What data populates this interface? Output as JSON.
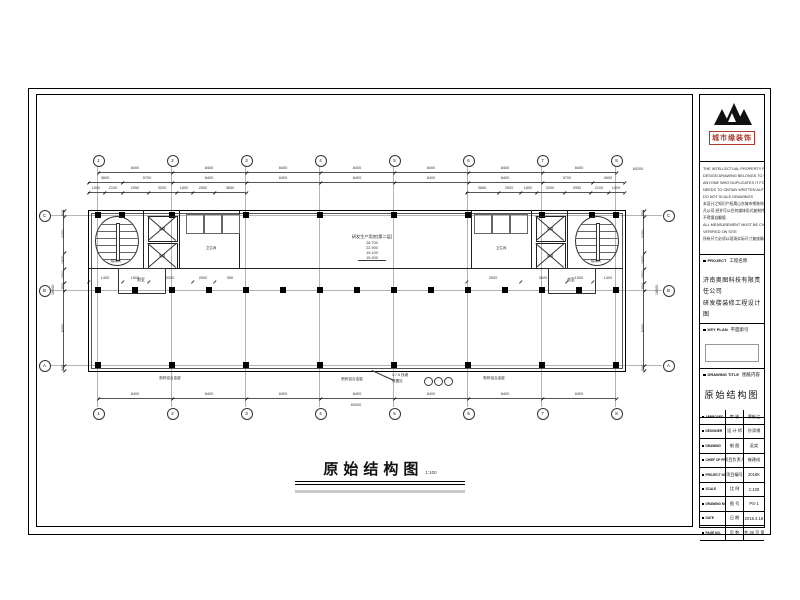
{
  "page": {
    "title_main": "原始结构图",
    "title_scale_label": "比例",
    "title_scale": "1:100"
  },
  "logo": {
    "name": "城市缘装饰",
    "accent_color": "#b03a2e"
  },
  "disclaimer": {
    "lines": [
      "THE INTELLECTUAL PROPERTY RIGHT OF THIS",
      "DESIGN DRAWING BELONGS TO DECORATION CO.,LTD",
      "ANYONE WHO DUPLICATES IT FOR USE",
      "NEEDS TO OBTAIN WRITTEN AUTHORIZATION",
      "DO NOT SCALE DRAWINGS",
      "本设计之知识产权属山东城市缘装饰所有",
      "凡公司,经许可以任何媒体形式复制传播,",
      "不得擅自翻版.",
      "ALL MEASUREMENT MUST BE CHECKED AND",
      "VERIFIED ON SITE",
      "所有尺寸必须以现场实际尺寸复核确认无误"
    ]
  },
  "title_block": {
    "project_label_en": "PROJECT",
    "project_label_cn": "工程名称",
    "project_name_line1": "济南奥图科技有限责任公司",
    "project_name_line2": "研发楼装修工程设计图",
    "key_plan_label_en": "KEY PLAN",
    "key_plan_label_cn": "平面索引",
    "drawing_title_label_en": "DRAWING TITLE",
    "drawing_title_label_cn": "图纸内容",
    "drawing_title_value": "原始结构图",
    "rows": [
      {
        "en": "APPROVED",
        "cn": "审 核",
        "value": "贾彬江"
      },
      {
        "en": "DESIGNER",
        "cn": "设 计 师",
        "value": "孙添祺"
      },
      {
        "en": "DRAWING",
        "cn": "制 图",
        "value": "吴笑"
      },
      {
        "en": "CHIEF OF PRO",
        "cn": "项目负责人",
        "value": "崔建成"
      },
      {
        "en": "PROJECT NO.",
        "cn": "项目编号",
        "value": "2016K"
      },
      {
        "en": "SCALE",
        "cn": "比 例",
        "value": "1:100"
      },
      {
        "en": "DRAWING NO.",
        "cn": "图 号",
        "value": "PS-1"
      },
      {
        "en": "DATE",
        "cn": "日 期",
        "value": "2016.4.18"
      },
      {
        "en": "PAGE NO.",
        "cn": "页 数",
        "value": "共 26 页 第 4 页"
      }
    ]
  },
  "plan": {
    "grid_cols": [
      "1",
      "2",
      "3",
      "4",
      "5",
      "6",
      "7",
      "8"
    ],
    "grid_rows": [
      "C",
      "B",
      "A"
    ],
    "room_label": "研发生产用房(第二层)",
    "levels": [
      "26.700",
      "22.900",
      "19.100",
      "15.300"
    ],
    "core_labels": {
      "stair": "楼梯间",
      "elevator": "电梯",
      "lobby": "前室",
      "wc": "卫生间"
    },
    "window_label": "断桥铝合金窗",
    "slope_note_line1": "1:7.5 找坡",
    "slope_note_line2": "详图见",
    "dims": {
      "bay": "8400",
      "top_total": "60200",
      "bottom_total": "60200",
      "side_total": "18000",
      "top_tier2": [
        "3600",
        "5700",
        "8400",
        "8400",
        "8400",
        "8400",
        "8400",
        "5700",
        "3600"
      ],
      "top_tier3_left": [
        "1500",
        "2100",
        "2950",
        "3200",
        "1800",
        "2500",
        "3650"
      ],
      "top_tier3_right": [
        "3650",
        "2500",
        "1800",
        "3200",
        "2950",
        "2100",
        "1500"
      ],
      "side_chain": [
        "600",
        "4200",
        "1800",
        "1500",
        "950",
        "8400",
        "600"
      ],
      "inner_left": [
        "1400",
        "1500",
        "3300",
        "2500",
        "950"
      ],
      "inner_right": [
        "2500",
        "3600",
        "1500",
        "1400"
      ]
    }
  }
}
